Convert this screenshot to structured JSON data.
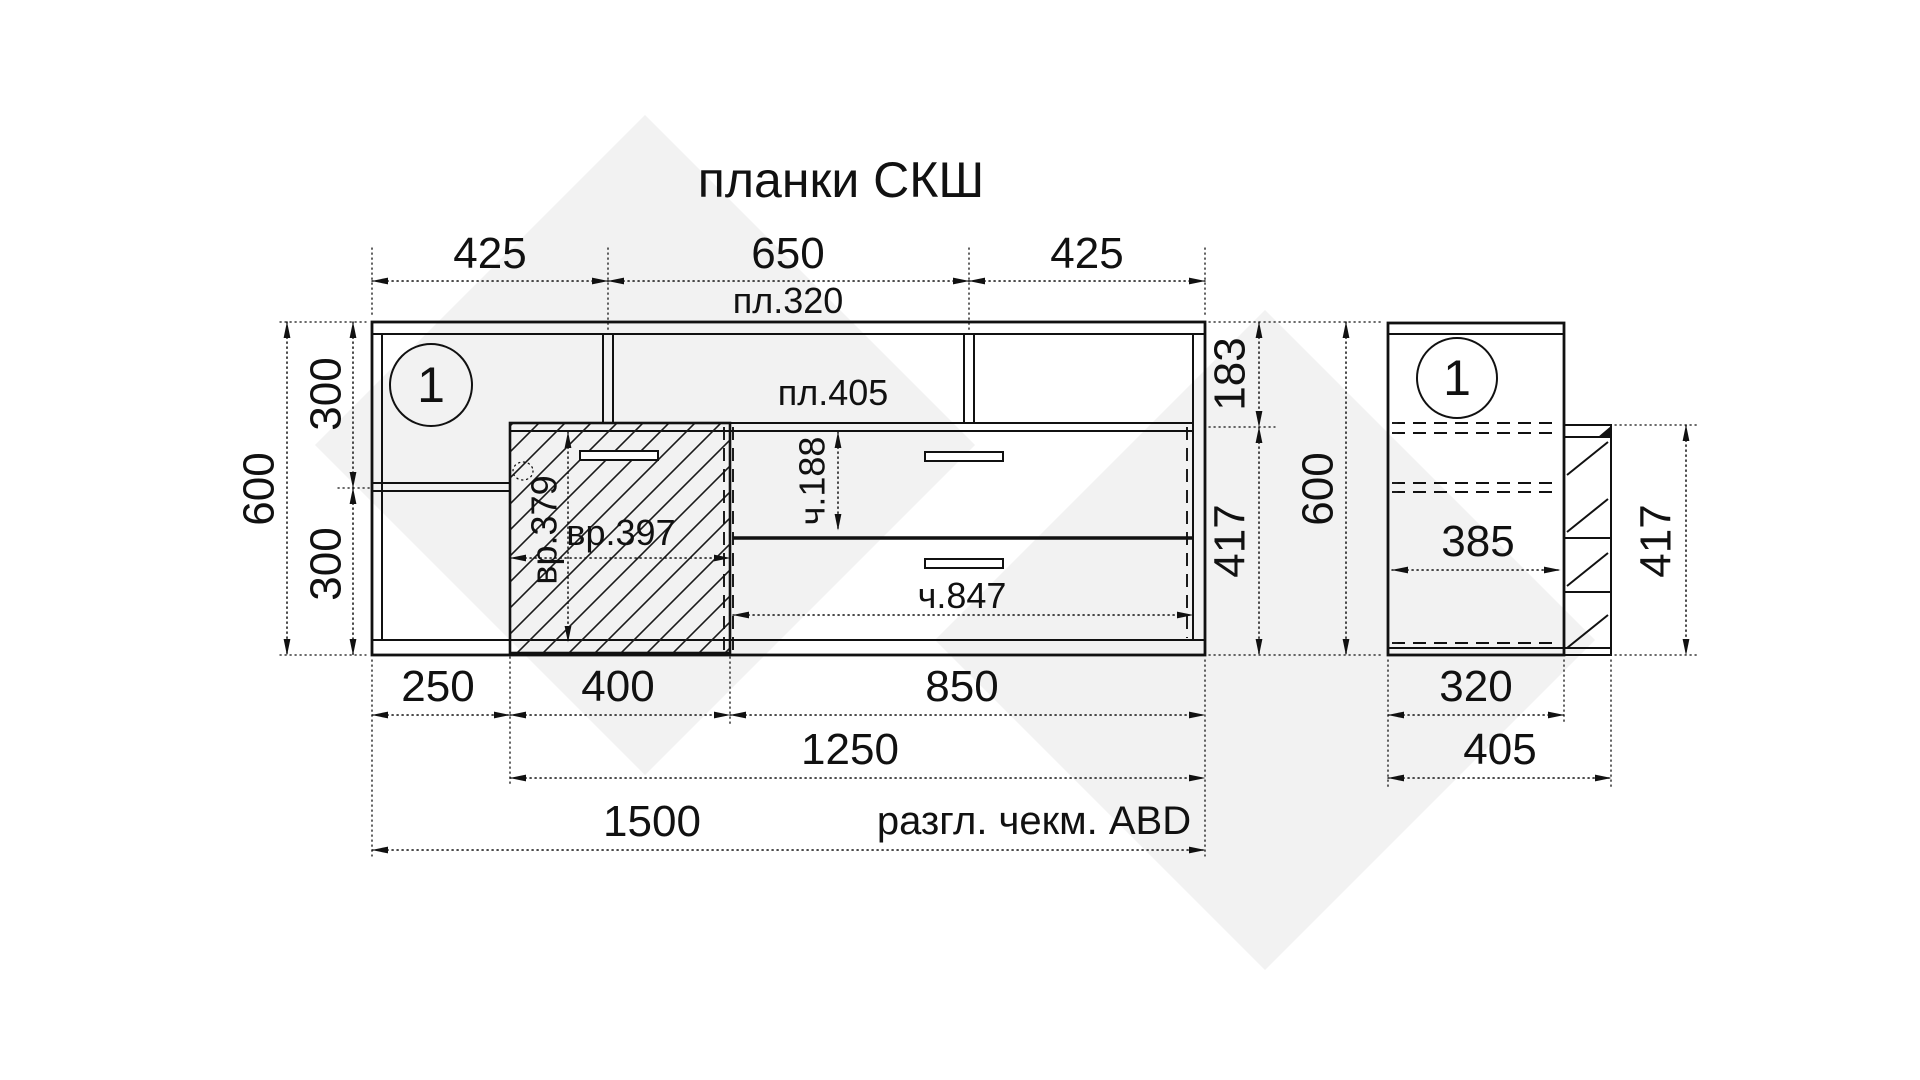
{
  "title": "планки СКШ",
  "front_view": {
    "marker": "1",
    "top": {
      "seg1": "425",
      "seg2": "650",
      "seg3": "425",
      "panel": "пл.320"
    },
    "left": {
      "total": "600",
      "upper": "300",
      "lower": "300"
    },
    "right": {
      "upper": "183",
      "lower": "417"
    },
    "inner": {
      "shelf": "пл.405",
      "door_h": "вр.379",
      "door_w": "вр.397",
      "drawer_h": "ч.188",
      "drawer_w": "ч.847"
    },
    "bottom": {
      "seg1": "250",
      "seg2": "400",
      "seg3": "850",
      "mid": "1250",
      "total": "1500",
      "note": "разгл. чекм. ABD"
    }
  },
  "side_view": {
    "marker": "1",
    "inner_width": "385",
    "front_height": "417",
    "total_height": "600",
    "bottom": {
      "body": "320",
      "total": "405"
    }
  },
  "colors": {
    "line": "#111111",
    "watermark": "#f2f2f2",
    "background": "#ffffff"
  }
}
